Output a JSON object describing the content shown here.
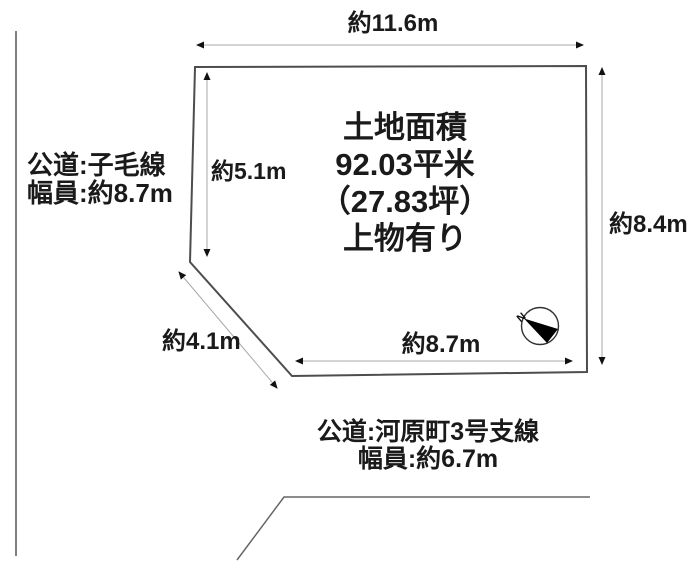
{
  "diagram": {
    "type": "land-plot-survey",
    "plot": {
      "line1": "土地面積",
      "line2": "92.03平米",
      "line3": "（27.83坪）",
      "line4": "上物有り"
    },
    "dimensions": {
      "top": "約11.6m",
      "left_inner": "約5.1m",
      "right": "約8.4m",
      "bottom_inner": "約8.7m",
      "diagonal": "約4.1m"
    },
    "roads": {
      "left": {
        "line1": "公道:子毛線",
        "line2": "幅員:約8.7m"
      },
      "bottom": {
        "line1": "公道:河原町3号支線",
        "line2": "幅員:約6.7m"
      }
    },
    "compass": {
      "north_label": "N"
    },
    "colors": {
      "background": "#ffffff",
      "plot_outline": "#4d4d4d",
      "dimension_line": "#a9a9a9",
      "arrowhead": "#111111",
      "frame_line": "#666666",
      "text": "#1a1a1a"
    }
  }
}
